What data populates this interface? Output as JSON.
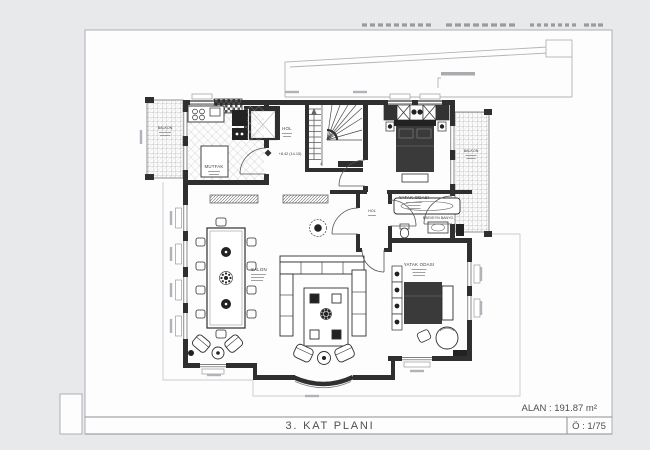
{
  "sheet": {
    "title": "3. KAT PLANI",
    "area": "ALAN : 191.87 m²",
    "scale": "Ö : 1/75"
  },
  "rooms": {
    "balcony_top_left": "BALKON",
    "kitchen": "MUTFAK",
    "hall_main": "HOL",
    "bedroom_top": "YATAK ODASI",
    "balcony_right": "BALKON",
    "parent_bathroom": "EBEVEYN BANYO",
    "hall_center": "HOL",
    "bedroom_bottom": "YATAK ODASI",
    "living_room": "SALON"
  },
  "annotations": {
    "elevation": "+8.42 (14.15)",
    "stair_count": "4"
  },
  "colors": {
    "wall_ink": "#2f2f2f",
    "sheet": "#fefefe",
    "background": "#e8e9eb",
    "frame_line": "#a8a8ae"
  }
}
